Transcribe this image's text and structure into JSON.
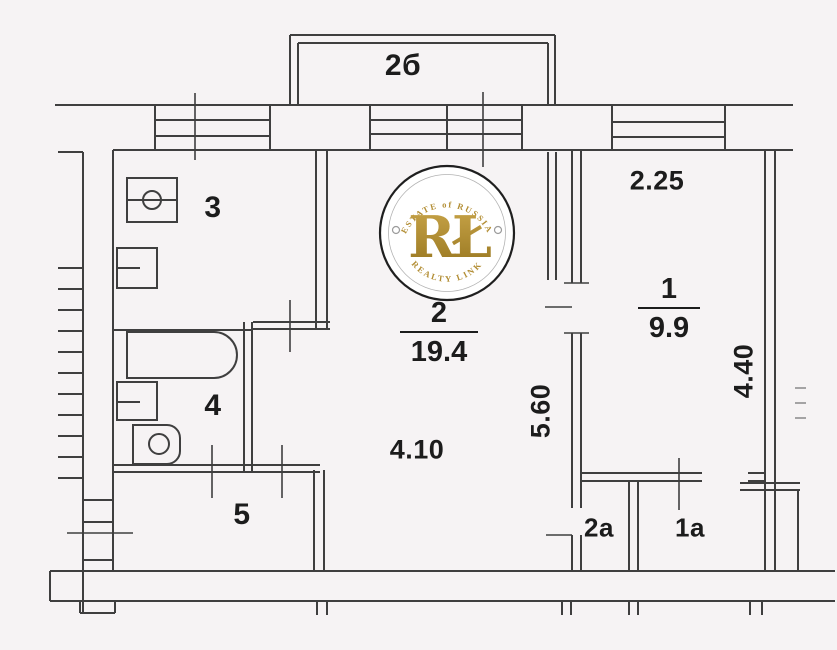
{
  "colors": {
    "background": "#f6f3f4",
    "line": "#3f3f3f",
    "label": "#1c1c1c",
    "gold": "#b28d33",
    "gold_light": "#caa64a",
    "gold_dark": "#96751f",
    "faint_mark": "#8f8f8f"
  },
  "balcony": {
    "label": "2б"
  },
  "rooms": {
    "kitchen": {
      "number": "3"
    },
    "living": {
      "number": "2",
      "area": "19.4"
    },
    "bedroom": {
      "number": "1",
      "area": "9.9"
    },
    "bathroom": {
      "number": "4"
    },
    "hallway": {
      "number": "5"
    },
    "closet_living": {
      "number": "2а"
    },
    "closet_bedroom": {
      "number": "1а"
    }
  },
  "dimensions": {
    "bedroom_nook_width": "2.25",
    "living_width": "4.10",
    "living_depth": "5.60",
    "bedroom_depth": "4.40"
  },
  "watermark": {
    "top_text": "ESTATE of RUSSIA",
    "monogram": "RŁ",
    "bottom_text": "REALTY LINK"
  }
}
